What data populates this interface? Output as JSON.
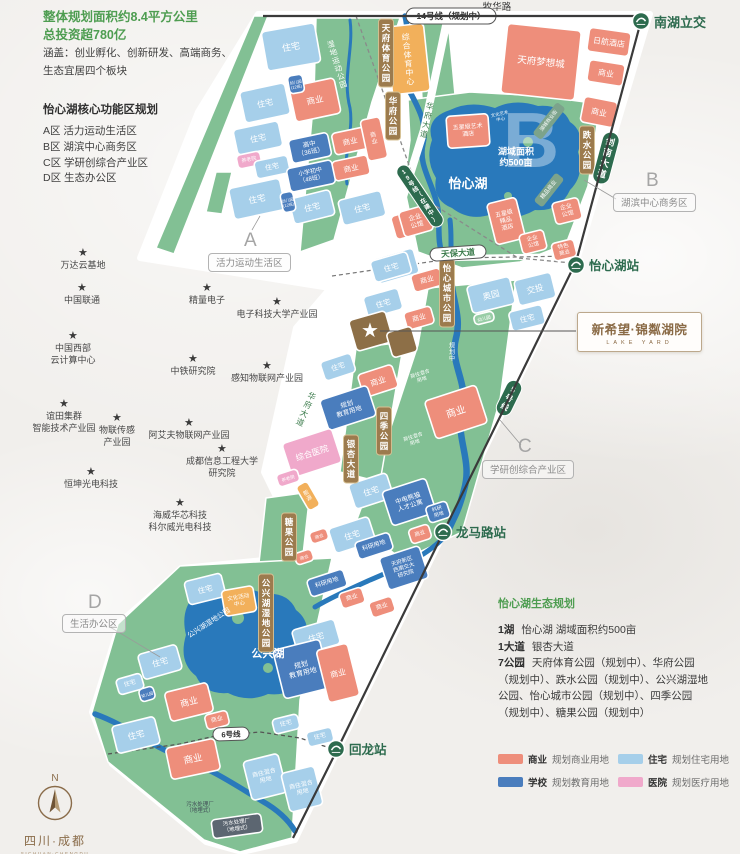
{
  "info_panel": {
    "line1": "整体规划面积约8.4平方公里",
    "line2": "总投资超780亿",
    "desc1": "涵盖：创业孵化、创新研发、高端商务、",
    "desc2": "生态宜居四个板块",
    "heading": "怡心湖核心功能区规划",
    "zones": [
      "A区   活力运动生活区",
      "B区   湖滨中心商务区",
      "C区   学研创综合产业区",
      "D区   生态办公区"
    ]
  },
  "zone_callouts": {
    "a": {
      "letter": "A",
      "label": "活力运动生活区"
    },
    "b": {
      "letter": "B",
      "label": "湖滨中心商务区"
    },
    "c": {
      "letter": "C",
      "label": "学研创综合产业区"
    },
    "d": {
      "letter": "D",
      "label": "生活办公区"
    }
  },
  "landmarks": {
    "star_icon": "★",
    "items": [
      "万达云基地",
      "中国联通",
      "精量电子",
      "电子科技大学产业园",
      "中国西部\n云计算中心",
      "中铁研究院",
      "感知物联网产业园",
      "谊田集群\n智能技术产业园",
      "物联传感\n产业园",
      "阿艾夫物联网产业园",
      "成都信息工程大学\n研究院",
      "恒坤光电科技",
      "海威华芯科技\n科尔威光电科技"
    ]
  },
  "map": {
    "labels": {
      "muhua_road": "牧华路",
      "line14": "14号线（规划中）",
      "line19": "19号线（在建中）",
      "line5": "5号线",
      "line6": "6号线",
      "jiannan_ave": "剑南大道",
      "tianbao_ave": "天保大道",
      "huafu_ave": "华府大道",
      "yinxing_ave": "银杏大道",
      "residential": "住宅",
      "commercial": "商业",
      "enterprise_hall": "企业\n公馆",
      "special_commercial": "特色\n商业",
      "boutique_commercial": "精品商业",
      "lake_commercial_street": "湖城商业街",
      "art_center": "文化艺术\n中心",
      "high_school": "高中\n（36班）",
      "primary_school": "小学初中\n（48班）",
      "kindergarten12": "幼儿园\n(12班)",
      "kindergarten": "幼儿园",
      "nursing_home": "养老院",
      "research_land": "科研用地",
      "research_land2": "科研\n用地",
      "edu_land": "规划\n教育用地",
      "hospital": "综合医院",
      "dream_city": "天府梦想城",
      "nikko_hotel": "日航酒店",
      "art_hotel": "五星级艺术\n酒店",
      "boutique_hotel": "五星级\n精品\n酒店",
      "lake_area": "湖域面积\n约500亩",
      "yixin_lake": "怡心湖",
      "gongxing_lake": "公兴湖",
      "aoyuan": "奥园",
      "jiaotou": "交投",
      "panda_apartment": "中电熊猫\n人才公寓",
      "jiaoda": "天府新区\n西南交大\n研究院",
      "mixed_use": "商住混合\n用地",
      "culture_center": "文化活动\n中心",
      "sewage_plant": "污水处理厂\n（地埋式）",
      "sports_center": "综合体育中心",
      "wetland_sports_park": "湿地运动公园",
      "gongxing_wetland_inner": "公兴湖湿地公园",
      "planning": "规划中",
      "creative_park": "创意公园",
      "energy": "能源",
      "tianfu_sports_park": "天府体育公园",
      "huafu_park": "华府公园",
      "dieshui_park": "跌水公园",
      "yixin_city_park": "怡心城市公园",
      "siji_park": "四季公园",
      "tangguo_park": "糖果公园",
      "gongxing_wetland_park": "公兴湖湿地公园"
    },
    "stations": {
      "nanhu": "南湖立交",
      "yixinhu": "怡心湖站",
      "longmalu": "龙马路站",
      "huilong": "回龙站"
    }
  },
  "project_logo": {
    "title": "新希望·锦粼湖院",
    "subtitle": "LAKE YARD"
  },
  "eco_panel": {
    "title": "怡心湖生态规划",
    "items": [
      {
        "k": "1湖",
        "v": "怡心湖  湖域面积约500亩"
      },
      {
        "k": "1大道",
        "v": "银杏大道"
      },
      {
        "k": "7公园",
        "v": "天府体育公园（规划中）、华府公园（规划中）、跌水公园（规划中）、公兴湖湿地公园、怡心城市公园（规划中）、四季公园（规划中）、糖果公园（规划中）"
      }
    ]
  },
  "legend": {
    "items": [
      {
        "label": "商业",
        "desc": "规划商业用地",
        "color": "#ee8e7b"
      },
      {
        "label": "住宅",
        "desc": "规划住宅用地",
        "color": "#a6cfea"
      },
      {
        "label": "学校",
        "desc": "规划教育用地",
        "color": "#4a7dbd"
      },
      {
        "label": "医院",
        "desc": "规划医疗用地",
        "color": "#f0a9cb"
      }
    ]
  },
  "compass": {
    "n": "N",
    "region": "四川·成都",
    "region_en": "SICHUAN·CHENGDU"
  },
  "colors": {
    "background": "#f1efec",
    "residential": "#a6cfea",
    "commercial": "#ee8e7b",
    "education": "#4a7dbd",
    "medical": "#f0a9cb",
    "park": "#82c094",
    "park_light": "#98cda6",
    "water": "#2979bb",
    "orange": "#f2b05b",
    "site_brown": "#8d6f47",
    "sewage_gray": "#5c6671",
    "tag_brown": "#9c7b4e",
    "tag_border": "#d7c294",
    "metro_green": "#2d6b4e",
    "line_dark": "#3a3a3a",
    "accent_green": "#4e9d51",
    "street_tag_green": "#7ca38b",
    "road_green_text": "#3e7d4e"
  }
}
